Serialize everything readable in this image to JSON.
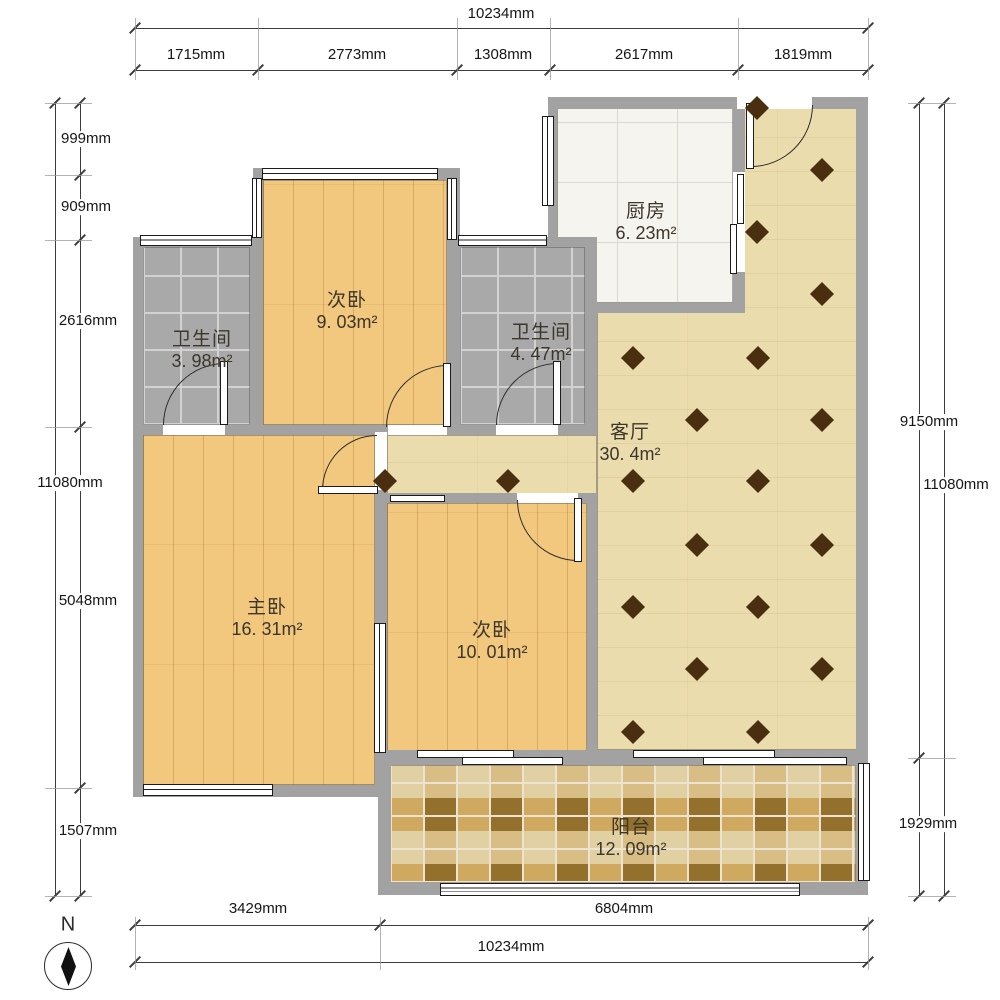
{
  "rooms": [
    {
      "id": "kitchen",
      "name": "厨房",
      "area": "6. 23m²"
    },
    {
      "id": "bedroom-1",
      "name": "次卧",
      "area": "9. 03m²"
    },
    {
      "id": "bathroom-1",
      "name": "卫生间",
      "area": "3. 98m²"
    },
    {
      "id": "bathroom-2",
      "name": "卫生间",
      "area": "4. 47m²"
    },
    {
      "id": "living-room",
      "name": "客厅",
      "area": "30. 4m²"
    },
    {
      "id": "master-bedroom",
      "name": "主卧",
      "area": "16. 31m²"
    },
    {
      "id": "bedroom-2",
      "name": "次卧",
      "area": "10. 01m²"
    },
    {
      "id": "balcony",
      "name": "阳台",
      "area": "12. 09m²"
    }
  ],
  "dimensions": {
    "top": {
      "overall": "10234mm",
      "segments": [
        "1715mm",
        "2773mm",
        "1308mm",
        "2617mm",
        "1819mm"
      ]
    },
    "left": {
      "overall": "11080mm",
      "segments": [
        "999mm",
        "909mm",
        "2616mm",
        "5048mm",
        "1507mm"
      ]
    },
    "right": {
      "overall": "11080mm",
      "segments": [
        "9150mm",
        "1929mm"
      ]
    },
    "bottom": {
      "overall": "10234mm",
      "segments": [
        "3429mm",
        "6804mm"
      ]
    }
  },
  "compass": {
    "north_label": "N"
  },
  "colors": {
    "wall": "#a2a2a2",
    "wood_floor": "#f2c77e",
    "living_floor": "#ebdcae",
    "bath_tile": "#a9a9a9",
    "kitchen_tile": "#f6f4ee",
    "balcony_tile": "#c8a45c",
    "diamond_accent": "#4a2e10"
  }
}
